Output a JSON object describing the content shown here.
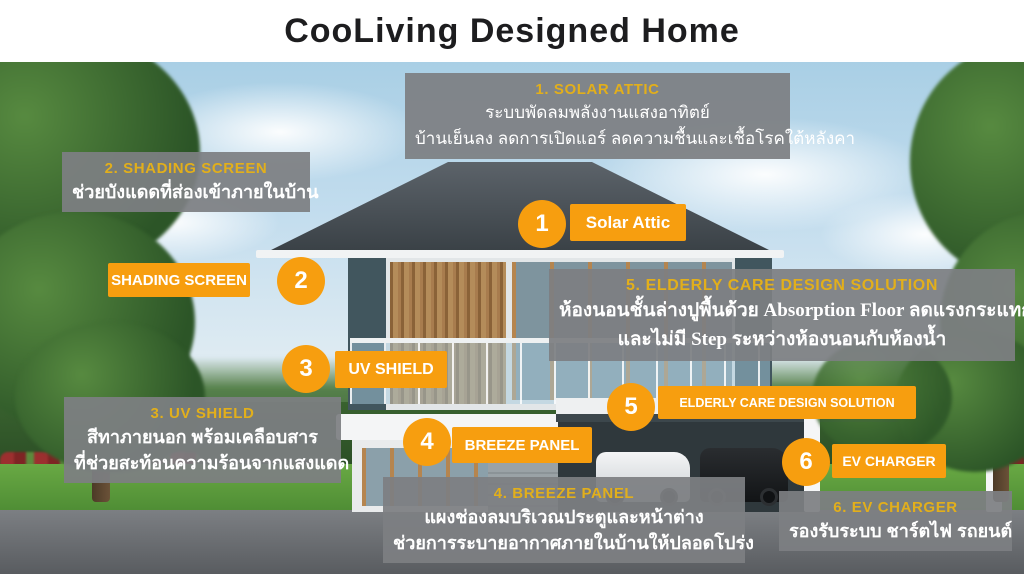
{
  "title": "CooLiving Designed Home",
  "colors": {
    "accent_orange": "#F79E0F",
    "header_gold": "#E2AF1B",
    "panel_gray": "#7D7F82",
    "title_black": "#1D1D1F"
  },
  "callouts": [
    {
      "header": "1. SOLAR ATTIC",
      "lines": [
        "ระบบพัดลมพลังงานแสงอาทิตย์",
        "บ้านเย็นลง ลดการเปิดแอร์ ลดความชื้นและเชื้อโรคใต้หลังคา"
      ],
      "badge": "1",
      "tag": "Solar Attic"
    },
    {
      "header": "2. SHADING SCREEN",
      "lines": [
        "ช่วยบังแดดที่ส่องเข้าภายในบ้าน"
      ],
      "badge": "2",
      "tag": "SHADING SCREEN"
    },
    {
      "header": "3. UV SHIELD",
      "lines": [
        "สีทาภายนอก พร้อมเคลือบสาร",
        "ที่ช่วยสะท้อนความร้อนจากแสงแดด"
      ],
      "badge": "3",
      "tag": "UV SHIELD"
    },
    {
      "header": "4. BREEZE  PANEL",
      "lines": [
        "แผงช่องลมบริเวณประตูและหน้าต่าง",
        "ช่วยการระบายอากาศภายในบ้านให้ปลอดโปร่ง"
      ],
      "badge": "4",
      "tag": "BREEZE PANEL"
    },
    {
      "header": "5. ELDERLY CARE DESIGN SOLUTION",
      "lines": [
        "ห้องนอนชั้นล่างปูพื้นด้วย Absorption Floor ลดแรงกระแทก",
        "และไม่มี Step ระหว่างห้องนอนกับห้องน้ำ"
      ],
      "badge": "5",
      "tag": "ELDERLY CARE DESIGN SOLUTION"
    },
    {
      "header": "6. EV CHARGER",
      "lines": [
        "รองรับระบบ ชาร์ตไฟ รถยนต์"
      ],
      "badge": "6",
      "tag": "EV CHARGER"
    }
  ]
}
